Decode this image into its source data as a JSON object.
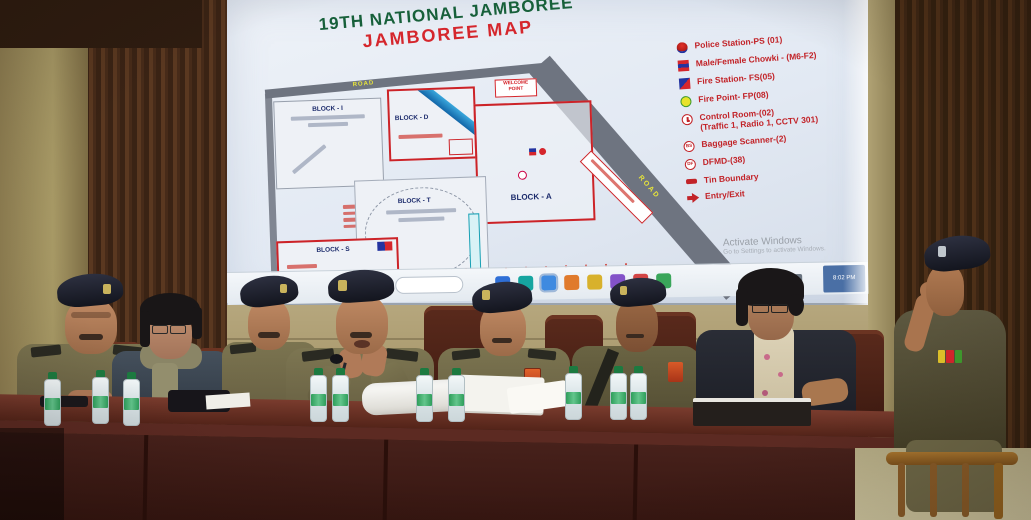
{
  "screen": {
    "title_line1": "19TH NATIONAL JAMBOREE",
    "title_line2": "JAMBOREE MAP",
    "map": {
      "block_i": "BLOCK - I",
      "block_d": "BLOCK - D",
      "block_a": "BLOCK - A",
      "block_t": "BLOCK - T",
      "block_s": "BLOCK - S",
      "welcome_point": "WELCOME POINT",
      "road_label": "ROAD",
      "bottom_letters": [
        "B",
        "L",
        "O",
        "C",
        "K"
      ]
    },
    "legend": {
      "items": [
        {
          "icon": "police-station",
          "label": "Police Station-PS (01)"
        },
        {
          "icon": "male-female-chowki",
          "label": "Male/Female Chowki - (M6-F2)"
        },
        {
          "icon": "fire-station",
          "label": "Fire Station- FS(05)"
        },
        {
          "icon": "fire-point",
          "label": "Fire Point- FP(08)"
        },
        {
          "icon": "control-room",
          "label": "Control Room-(02)",
          "label2": "(Traffic 1, Radio 1, CCTV 301)"
        },
        {
          "icon": "baggage-scanner",
          "label": "Baggage Scanner-(2)",
          "icon_text": "BS"
        },
        {
          "icon": "dfmd",
          "label": "DFMD-(38)",
          "icon_text": "DF"
        },
        {
          "icon": "tin-boundary",
          "label": "Tin Boundary"
        },
        {
          "icon": "entry-exit",
          "label": "Entry/Exit"
        }
      ]
    },
    "watermark": {
      "line1": "Activate Windows",
      "line2": "Go to Settings to activate Windows."
    },
    "taskbar": {
      "time": "8:02 PM"
    }
  },
  "colors": {
    "title_green": "#17603a",
    "title_red": "#d5262c",
    "legend_red": "#c22328",
    "map_outline_red": "#cc2328",
    "road_gray": "#6e7480",
    "road_label_yellow": "#e7e43a",
    "screen_bg": "#e8edf5",
    "uniform_khaki": "#6e6847",
    "beret_navy": "#1e2130",
    "table_wood": "#47211b",
    "wall_wood_dark": "#4a2d19",
    "wall_wood_light": "#a89a66",
    "bottle_green": "#2e9e5b"
  }
}
